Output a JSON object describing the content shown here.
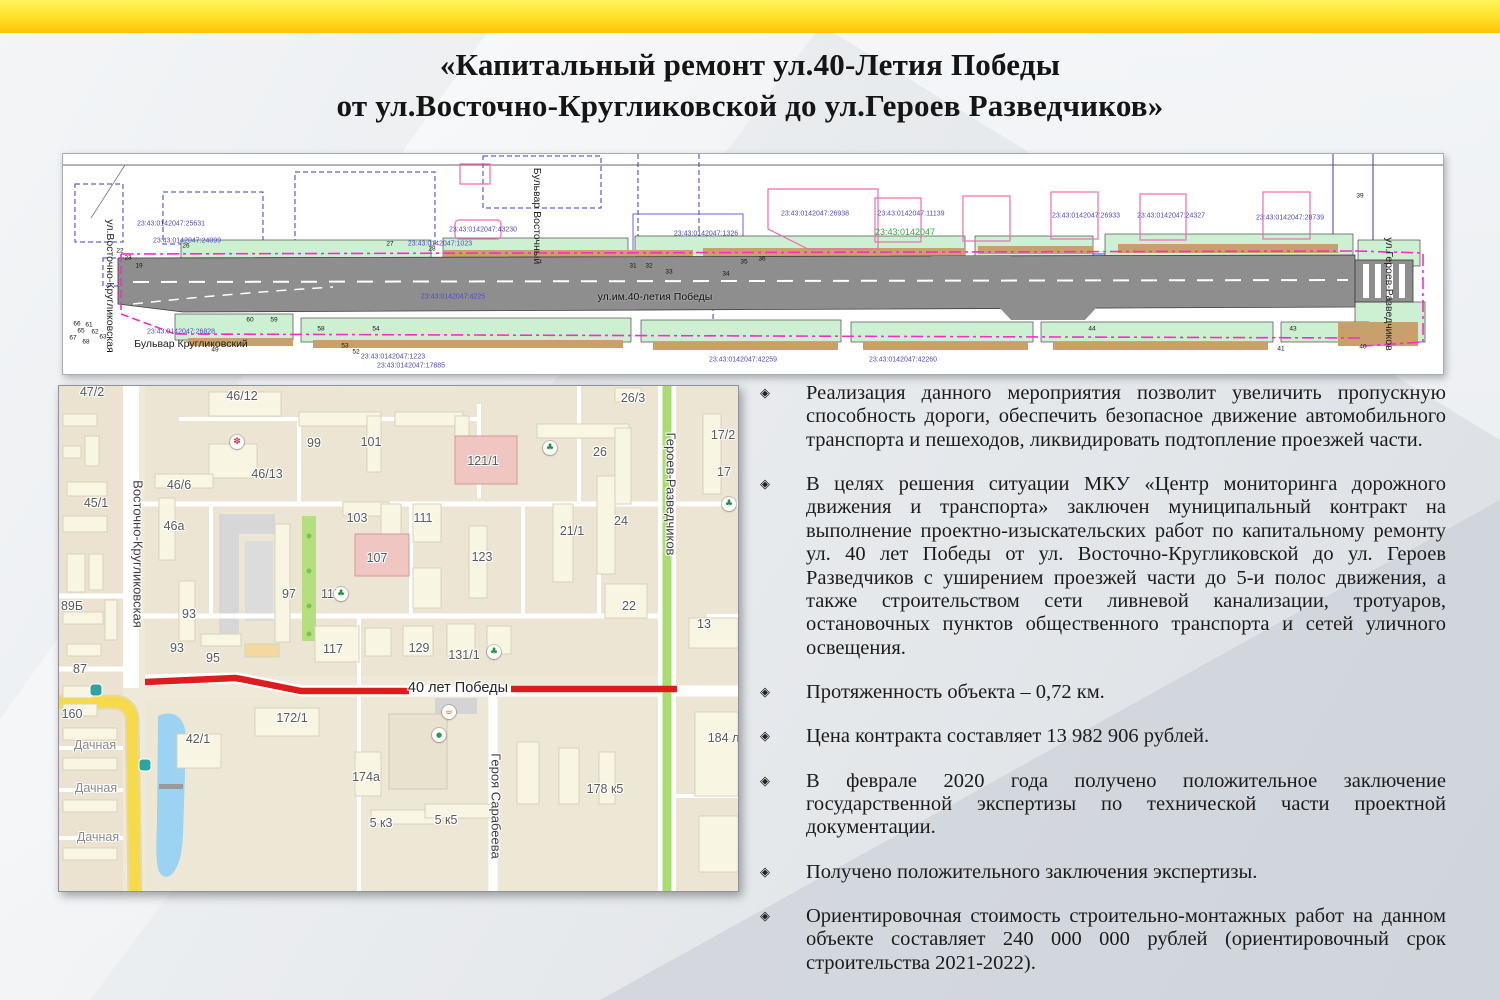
{
  "title": {
    "line1": "«Капитальный ремонт ул.40-Летия Победы",
    "line2": "от ул.Восточно-Кругликовской до ул.Героев Разведчиков»"
  },
  "colors": {
    "accent_yellow": "#FDC406",
    "route_red": "#DD1D1D",
    "map_green_road": "#ABDC72",
    "map_water": "#9CD2F2",
    "blueprint_magenta": "#FF29C8",
    "cadastral_blue": "#4F49C8",
    "cadastral_green": "#2FAE3A"
  },
  "bullets": {
    "marker": "◈",
    "items": [
      "Реализация данного мероприятия позволит увеличить пропускную способность дороги, обеспечить безопасное движение автомобильного транспорта и пешеходов, ликвидировать подтопление проезжей части.",
      "В целях решения ситуации МКУ «Центр мониторинга дорожного движения и транспорта» заключен муниципальный контракт на выполнение проектно-изыскательских работ по капитальному ремонту ул. 40 лет Победы от ул. Восточно-Кругликовской до ул. Героев Разведчиков с уширением проезжей части до 5-и полос движения, а также строительством сети ливневой канализации, тротуаров, остановочных пунктов общественного транспорта и сетей уличного освещения.",
      "Протяженность объекта – 0,72 км.",
      "Цена контракта составляет 13 982 906 рублей.",
      "В феврале 2020 года получено положительное заключение государственной экспертизы по технической части проектной документации.",
      "Получено положительного заключения экспертизы.",
      "Ориентировочная стоимость строительно-монтажных работ на данном объекте составляет 240 000 000 рублей (ориентировочный срок строительства 2021-2022)."
    ]
  },
  "blueprint": {
    "street_labels": [
      {
        "text": "ул.Восточно-Кругликовская",
        "x": 47,
        "y": 132,
        "cls": "v bp-street",
        "name": "blueprint-street-vostochno-kruglikovskaya"
      },
      {
        "text": "Бульвар Кругликовский",
        "x": 128,
        "y": 190,
        "cls": "bp-street",
        "name": "blueprint-street-bulvar-kruglikovsky"
      },
      {
        "text": "Бульвар Восточный",
        "x": 474,
        "y": 62,
        "cls": "v bp-street",
        "name": "blueprint-street-bulvar-vostochny"
      },
      {
        "text": "ул.им.40-летия Победы",
        "x": 592,
        "y": 143,
        "cls": "bp-street bp-road-label",
        "name": "blueprint-street-40-letiya-pobedy"
      },
      {
        "text": "ул.Героев-Разведчиков",
        "x": 1326,
        "y": 140,
        "cls": "v bp-street",
        "name": "blueprint-street-geroev-razvedchikov"
      }
    ],
    "cadastral_labels": [
      {
        "text": "23:43:0142047:25631",
        "x": 108,
        "y": 70
      },
      {
        "text": "23:43:0142047:24099",
        "x": 124,
        "y": 87
      },
      {
        "text": "23:43:0142047:26828",
        "x": 118,
        "y": 178
      },
      {
        "text": "23:43:0142047:1023",
        "x": 377,
        "y": 90
      },
      {
        "text": "23:43:0142047:43230",
        "x": 420,
        "y": 76
      },
      {
        "text": "23:43:0142047:4225",
        "x": 390,
        "y": 143
      },
      {
        "text": "23:43:0142047:1326",
        "x": 643,
        "y": 80
      },
      {
        "text": "23:43:0142047:26938",
        "x": 752,
        "y": 60
      },
      {
        "text": "23:43:0142047",
        "x": 842,
        "y": 78,
        "cls": "bp-cad cg"
      },
      {
        "text": "23:43:0142047:11139",
        "x": 848,
        "y": 60
      },
      {
        "text": "23:43:0142047:26933",
        "x": 1023,
        "y": 62
      },
      {
        "text": "23:43:0142047:24327",
        "x": 1108,
        "y": 62
      },
      {
        "text": "23:43:0142047:28739",
        "x": 1227,
        "y": 64
      },
      {
        "text": "23:43:0142047:1223",
        "x": 330,
        "y": 203
      },
      {
        "text": "23:43:0142047:17885",
        "x": 348,
        "y": 212
      },
      {
        "text": "23:43:0142047:42259",
        "x": 680,
        "y": 206
      },
      {
        "text": "23:43:0142047:42260",
        "x": 840,
        "y": 206
      }
    ],
    "point_markers": [
      {
        "text": "19",
        "x": 76,
        "y": 112
      },
      {
        "text": "22",
        "x": 57,
        "y": 97
      },
      {
        "text": "23",
        "x": 65,
        "y": 104
      },
      {
        "text": "26",
        "x": 123,
        "y": 92
      },
      {
        "text": "27",
        "x": 327,
        "y": 90
      },
      {
        "text": "28",
        "x": 369,
        "y": 95
      },
      {
        "text": "31",
        "x": 570,
        "y": 112
      },
      {
        "text": "32",
        "x": 586,
        "y": 112
      },
      {
        "text": "33",
        "x": 606,
        "y": 118
      },
      {
        "text": "34",
        "x": 663,
        "y": 120
      },
      {
        "text": "35",
        "x": 681,
        "y": 108
      },
      {
        "text": "36",
        "x": 699,
        "y": 105
      },
      {
        "text": "60",
        "x": 187,
        "y": 166
      },
      {
        "text": "59",
        "x": 211,
        "y": 166
      },
      {
        "text": "58",
        "x": 258,
        "y": 175
      },
      {
        "text": "54",
        "x": 313,
        "y": 175
      },
      {
        "text": "61",
        "x": 26,
        "y": 171
      },
      {
        "text": "62",
        "x": 32,
        "y": 178
      },
      {
        "text": "63",
        "x": 40,
        "y": 183
      },
      {
        "text": "65",
        "x": 18,
        "y": 177
      },
      {
        "text": "66",
        "x": 14,
        "y": 170
      },
      {
        "text": "67",
        "x": 10,
        "y": 184
      },
      {
        "text": "68",
        "x": 23,
        "y": 188
      },
      {
        "text": "49",
        "x": 152,
        "y": 196
      },
      {
        "text": "53",
        "x": 282,
        "y": 192
      },
      {
        "text": "52",
        "x": 293,
        "y": 198
      },
      {
        "text": "44",
        "x": 1029,
        "y": 175
      },
      {
        "text": "43",
        "x": 1230,
        "y": 175
      },
      {
        "text": "39",
        "x": 1297,
        "y": 42
      },
      {
        "text": "40",
        "x": 1300,
        "y": 193
      },
      {
        "text": "41",
        "x": 1218,
        "y": 195
      }
    ]
  },
  "map": {
    "street_labels": [
      {
        "text": "Восточно-Кругликовская",
        "x": 79,
        "y": 168,
        "cls": "v map-street",
        "name": "map-street-vostochno-kruglikovskaya"
      },
      {
        "text": "Героев-Разведчиков",
        "x": 612,
        "y": 108,
        "cls": "v map-street",
        "name": "map-street-geroev-razvedchikov"
      },
      {
        "text": "Героя Сарабеева",
        "x": 437,
        "y": 420,
        "cls": "v map-street",
        "name": "map-street-geroya-sarabeeva"
      },
      {
        "text": "40 лет Победы",
        "x": 399,
        "y": 302,
        "cls": "map-street map-route",
        "name": "map-street-40-let-pobedy"
      },
      {
        "text": "Дачная",
        "x": 36,
        "y": 359,
        "cls": "map-street-minor",
        "name": "map-street-dachnaya"
      },
      {
        "text": "Дачная",
        "x": 37,
        "y": 402,
        "cls": "map-street-minor",
        "name": "map-street-dachnaya"
      },
      {
        "text": "Дачная",
        "x": 39,
        "y": 451,
        "cls": "map-street-minor",
        "name": "map-street-dachnaya"
      }
    ],
    "building_labels": [
      {
        "text": "47/2",
        "x": 33,
        "y": 6
      },
      {
        "text": "46/12",
        "x": 183,
        "y": 10
      },
      {
        "text": "99",
        "x": 255,
        "y": 57
      },
      {
        "text": "101",
        "x": 312,
        "y": 56
      },
      {
        "text": "46/13",
        "x": 208,
        "y": 88
      },
      {
        "text": "46/6",
        "x": 120,
        "y": 99
      },
      {
        "text": "45/1",
        "x": 37,
        "y": 117
      },
      {
        "text": "46а",
        "x": 115,
        "y": 140
      },
      {
        "text": "103",
        "x": 298,
        "y": 132
      },
      {
        "text": "107",
        "x": 318,
        "y": 172
      },
      {
        "text": "111",
        "x": 364,
        "y": 132
      },
      {
        "text": "121/1",
        "x": 424,
        "y": 75
      },
      {
        "text": "26/3",
        "x": 574,
        "y": 12
      },
      {
        "text": "26",
        "x": 541,
        "y": 66
      },
      {
        "text": "17/2",
        "x": 664,
        "y": 49
      },
      {
        "text": "17",
        "x": 665,
        "y": 86
      },
      {
        "text": "24",
        "x": 562,
        "y": 135
      },
      {
        "text": "21/1",
        "x": 513,
        "y": 145
      },
      {
        "text": "123",
        "x": 423,
        "y": 171
      },
      {
        "text": "115",
        "x": 272,
        "y": 208
      },
      {
        "text": "97",
        "x": 230,
        "y": 208
      },
      {
        "text": "93",
        "x": 130,
        "y": 228
      },
      {
        "text": "93",
        "x": 118,
        "y": 262
      },
      {
        "text": "95",
        "x": 154,
        "y": 272
      },
      {
        "text": "89Б",
        "x": 13,
        "y": 220
      },
      {
        "text": "87",
        "x": 21,
        "y": 283
      },
      {
        "text": "22",
        "x": 570,
        "y": 220
      },
      {
        "text": "13",
        "x": 645,
        "y": 238
      },
      {
        "text": "160",
        "x": 13,
        "y": 328
      },
      {
        "text": "117",
        "x": 274,
        "y": 263
      },
      {
        "text": "129",
        "x": 360,
        "y": 262
      },
      {
        "text": "131/1",
        "x": 405,
        "y": 269
      },
      {
        "text": "172/1",
        "x": 233,
        "y": 332
      },
      {
        "text": "42/1",
        "x": 139,
        "y": 353
      },
      {
        "text": "174а",
        "x": 307,
        "y": 391
      },
      {
        "text": "5 к3",
        "x": 322,
        "y": 437
      },
      {
        "text": "5 к5",
        "x": 387,
        "y": 434
      },
      {
        "text": "178 к5",
        "x": 546,
        "y": 403
      },
      {
        "text": "184 ли",
        "x": 668,
        "y": 352
      }
    ],
    "icons": [
      {
        "name": "landmark-flower-icon",
        "x": 178,
        "y": 56,
        "cls": "ic-flower",
        "glyph": "✽"
      },
      {
        "name": "eco-icon",
        "x": 282,
        "y": 208,
        "cls": "ic-green",
        "glyph": "♣"
      },
      {
        "name": "eco-icon",
        "x": 491,
        "y": 62,
        "cls": "ic-green",
        "glyph": "♣"
      },
      {
        "name": "eco-icon",
        "x": 670,
        "y": 118,
        "cls": "ic-green",
        "glyph": "♣"
      },
      {
        "name": "eco-icon",
        "x": 435,
        "y": 266,
        "cls": "ic-green",
        "glyph": "♣"
      },
      {
        "name": "cafe-icon",
        "x": 390,
        "y": 326,
        "cls": "ic-cafe",
        "glyph": "☕"
      },
      {
        "name": "shop-cart-icon",
        "x": 380,
        "y": 349,
        "cls": "ic-cart",
        "glyph": "●"
      },
      {
        "name": "bus-stop-icon",
        "x": 37,
        "y": 304,
        "cls": "ic-bus",
        "glyph": ""
      },
      {
        "name": "bus-stop-icon",
        "x": 86,
        "y": 379,
        "cls": "ic-bus",
        "glyph": ""
      }
    ]
  }
}
